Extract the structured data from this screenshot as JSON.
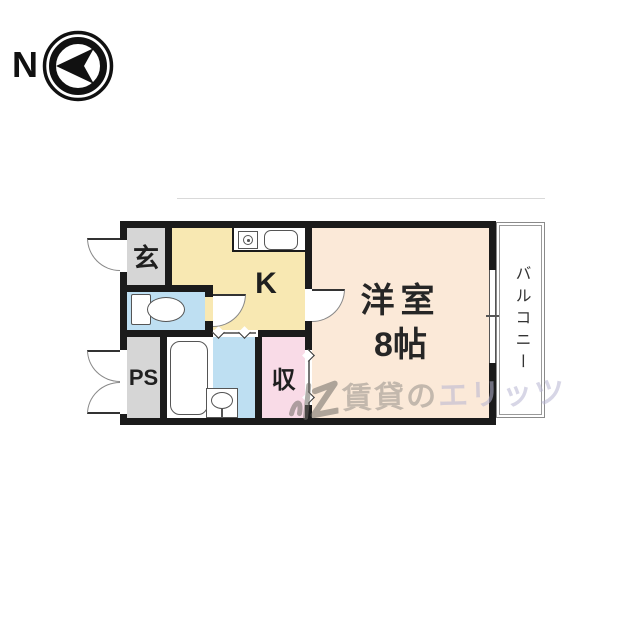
{
  "compass": {
    "north_label": "N"
  },
  "rooms": {
    "genkan": {
      "label": "玄"
    },
    "kitchen": {
      "label": "K"
    },
    "pipe_space": {
      "label": "PS"
    },
    "storage": {
      "label": "収"
    },
    "main_room": {
      "label_line1": "洋室",
      "label_line2": "8帖"
    },
    "balcony": {
      "label": "バルコニー"
    }
  },
  "watermark": {
    "prefix": "賃貸の",
    "brand": "エリッツ"
  },
  "icons": {
    "compass-arrow": "left-pointing north arrow in double ring",
    "toilet": "toilet tank and bowl",
    "bathtub": "rounded bathtub outline",
    "washbasin": "square basin with oval bowl",
    "kitchen-sink": "rounded rectangle sink",
    "stove-burner": "square single burner with circle"
  },
  "colors": {
    "wall": "#1b1b1b",
    "genkan_fill": "#d6d6d6",
    "kitchen_fill": "#f8e8b2",
    "water_fill": "#bedff2",
    "storage_fill": "#f9dbe7",
    "main_room_fill": "#fbe9d8",
    "balcony_fill": "#ffffff",
    "watermark_gray": "#96918a",
    "watermark_purple": "#b7b5d2"
  }
}
